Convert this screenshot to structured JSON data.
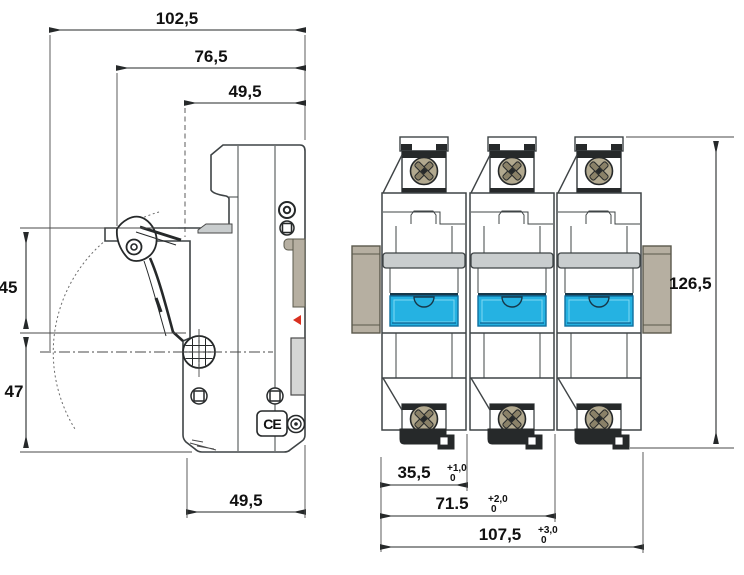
{
  "title": "Fuse holder dimension drawing",
  "colors": {
    "line": "#3f4446",
    "rail": "#b6afa1",
    "rail_border": "#5a594c",
    "screw": "#b2a98f",
    "screw_dark": "#26292a",
    "dark": "#26292a",
    "blue": "#25b2e2",
    "blue_dark": "#16384a",
    "blue_mid": "#0f6f9f",
    "gray_cap": "#c9cdce",
    "gray_flange": "#d5d6d5",
    "red": "#d93020"
  },
  "side_view": {
    "dim_overall_width": "102,5",
    "dim_open_width": "76,5",
    "dim_top_width": "49,5",
    "dim_upper_height": "45",
    "dim_lower_height": "47",
    "dim_bottom_width": "49,5",
    "ce_mark": "CE"
  },
  "front_view": {
    "pole_count": 3,
    "dim_height": "126,5",
    "dim_one_pole": "35,5",
    "dim_one_pole_tol_upper": "+1,0",
    "dim_one_pole_tol_lower": "0",
    "dim_two_pole": "71.5",
    "dim_two_pole_tol_upper": "+2,0",
    "dim_two_pole_tol_lower": "0",
    "dim_three_pole": "107,5",
    "dim_three_pole_tol_upper": "+3,0",
    "dim_three_pole_tol_lower": "0"
  }
}
